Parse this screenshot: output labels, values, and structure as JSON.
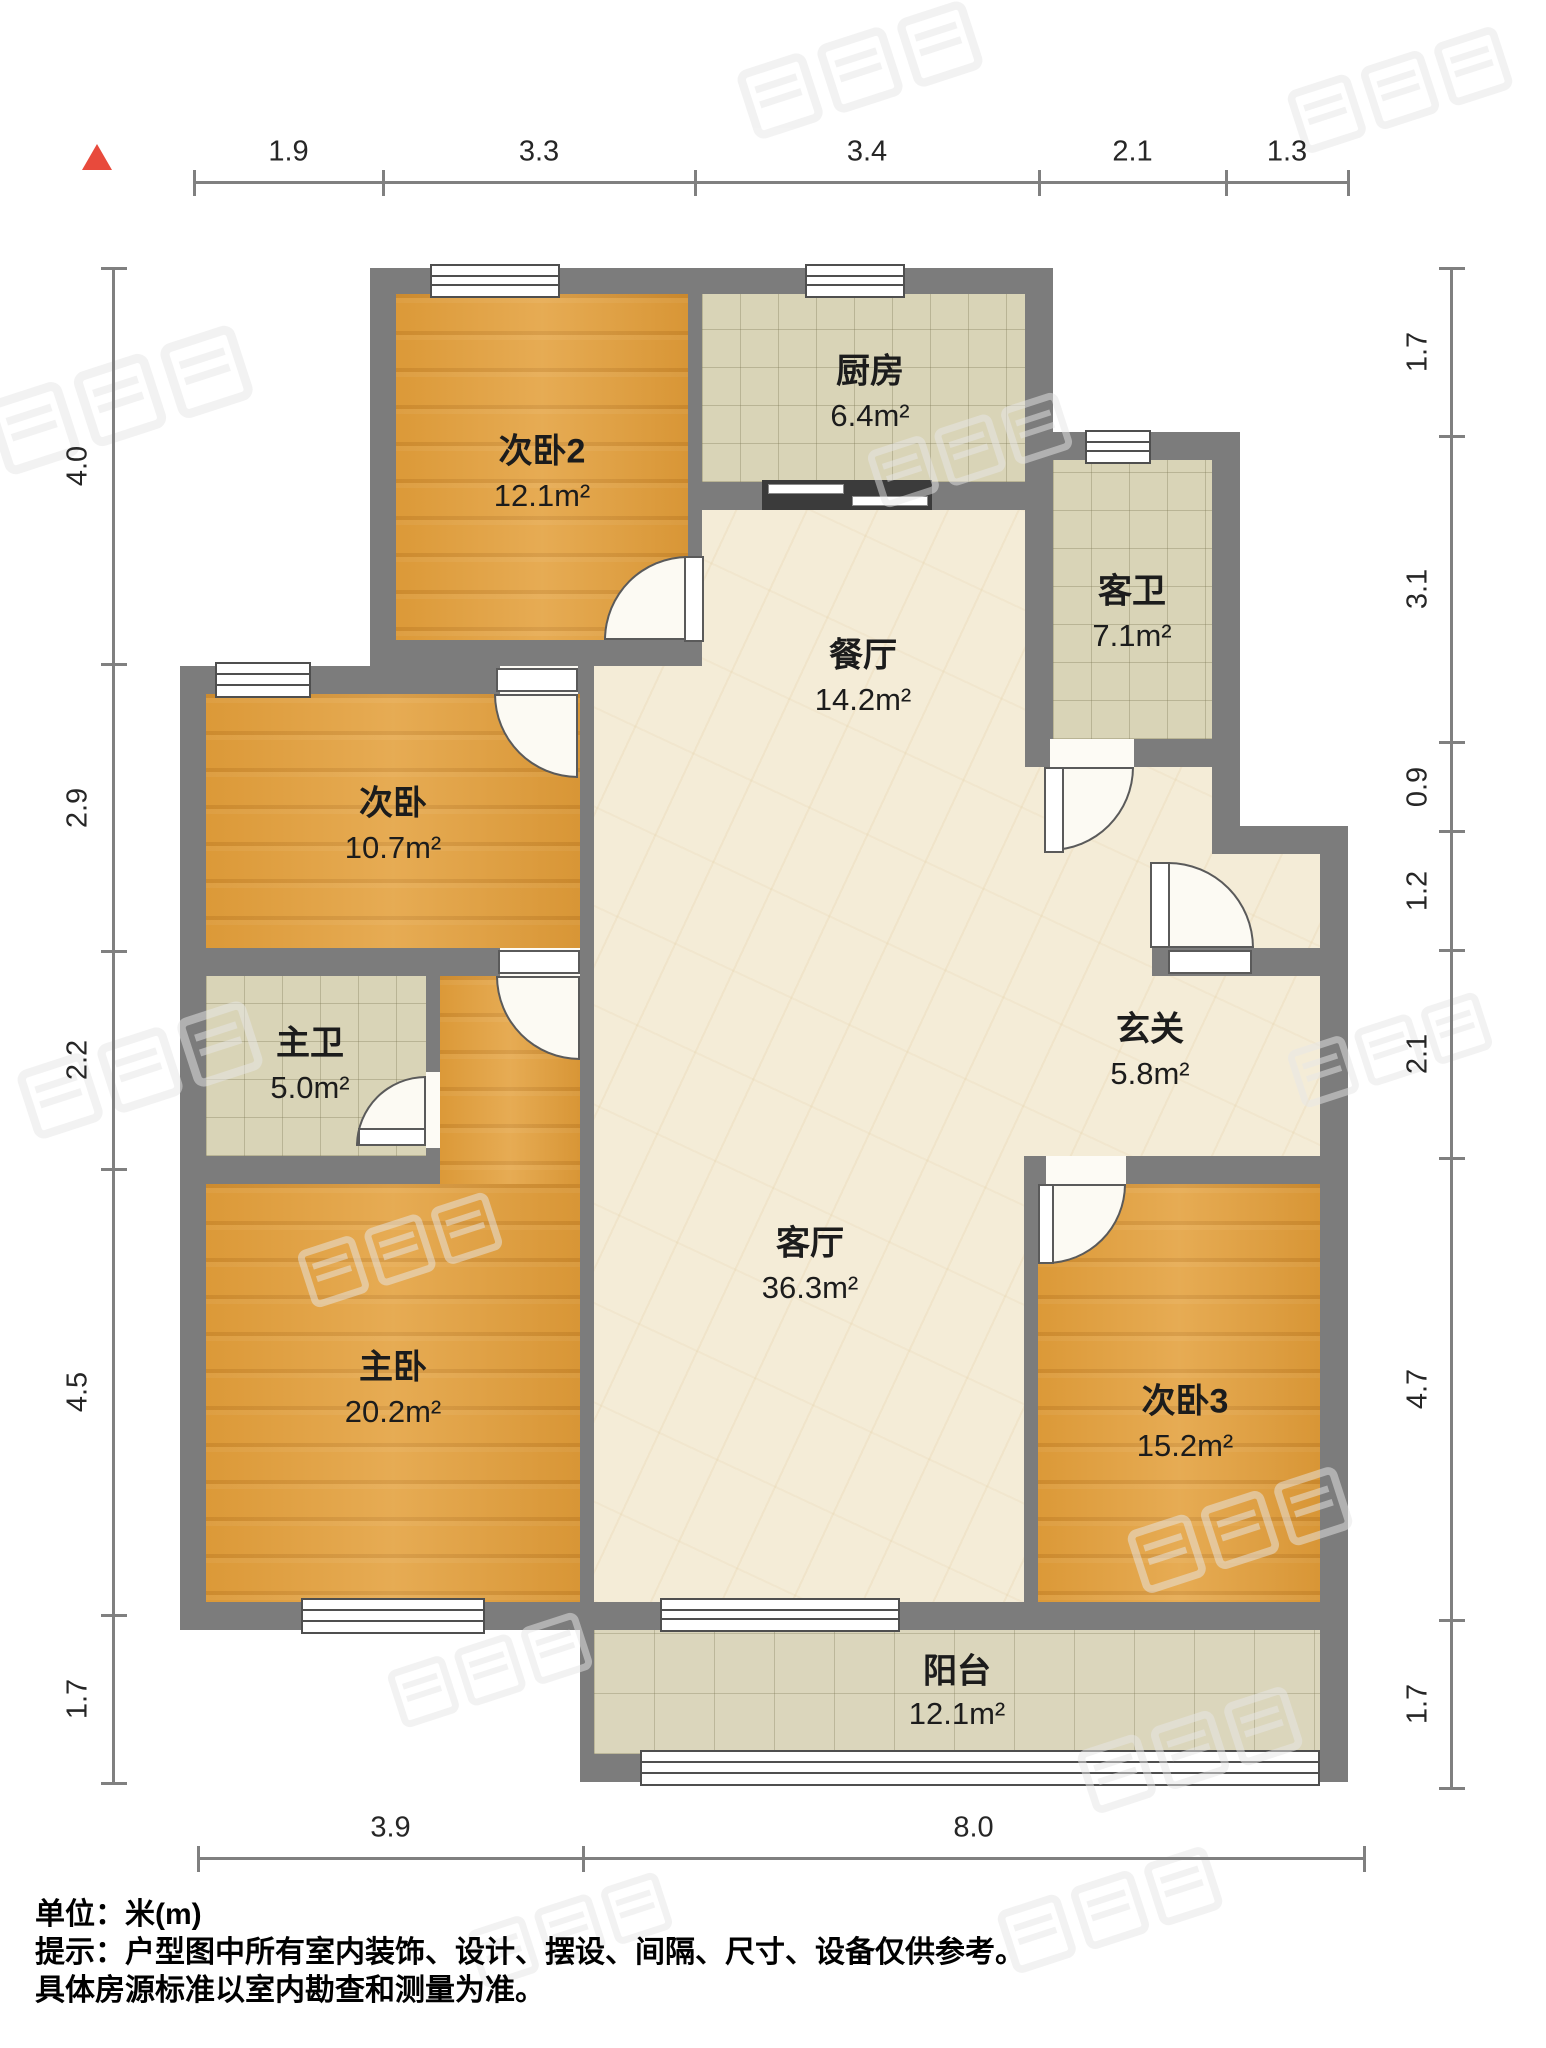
{
  "title": "户型图",
  "unit_label": "单位：米(m)",
  "notes": {
    "line1": "单位：米(m)",
    "line2": "提示：户型图中所有室内装饰、设计、摆设、间隔、尺寸、设备仅供参考。",
    "line3": "具体房源标准以室内勘查和测量为准。"
  },
  "colors": {
    "wall": "#7c7c7c",
    "wood_floor": "#e3a03c",
    "tile_floor": "#d9d4b7",
    "marble_floor": "#f4ecd7",
    "north_arrow": "#e84a3c",
    "dim_text": "#262626"
  },
  "north_icon": "north-triangle-icon",
  "rooms": [
    {
      "id": "living",
      "name": "客厅",
      "area": "36.3m²",
      "floor": "marble",
      "rects": [
        [
          594,
          510,
          726,
          1092
        ]
      ],
      "label": [
        810,
        1240
      ],
      "area_pos": [
        810,
        1288
      ]
    },
    {
      "id": "bedroom2",
      "name": "次卧2",
      "area": "12.1m²",
      "floor": "wood",
      "rects": [
        [
          396,
          294,
          292,
          346
        ]
      ],
      "label": [
        542,
        448
      ],
      "area_pos": [
        542,
        496
      ]
    },
    {
      "id": "kitchen",
      "name": "厨房",
      "area": "6.4m²",
      "floor": "tile",
      "rects": [
        [
          702,
          294,
          323,
          188
        ]
      ],
      "label": [
        870,
        368
      ],
      "area_pos": [
        870,
        416
      ]
    },
    {
      "id": "guestbath",
      "name": "客卫",
      "area": "7.1m²",
      "floor": "tile",
      "rects": [
        [
          1053,
          460,
          159,
          279
        ]
      ],
      "label": [
        1132,
        588
      ],
      "area_pos": [
        1132,
        636
      ]
    },
    {
      "id": "dining",
      "name": "餐厅",
      "area": "14.2m²",
      "floor": "none",
      "rects": [],
      "label": [
        863,
        652
      ],
      "area_pos": [
        863,
        700
      ]
    },
    {
      "id": "bedroom",
      "name": "次卧",
      "area": "10.7m²",
      "floor": "wood",
      "rects": [
        [
          206,
          694,
          374,
          254
        ]
      ],
      "label": [
        393,
        800
      ],
      "area_pos": [
        393,
        848
      ]
    },
    {
      "id": "masterbath",
      "name": "主卫",
      "area": "5.0m²",
      "floor": "tile",
      "rects": [
        [
          206,
          976,
          220,
          180
        ]
      ],
      "label": [
        310,
        1040
      ],
      "area_pos": [
        310,
        1088
      ]
    },
    {
      "id": "entry",
      "name": "玄关",
      "area": "5.8m²",
      "floor": "none",
      "rects": [],
      "label": [
        1150,
        1026
      ],
      "area_pos": [
        1150,
        1074
      ]
    },
    {
      "id": "master",
      "name": "主卧",
      "area": "20.2m²",
      "floor": "wood",
      "rects": [
        [
          440,
          976,
          140,
          626
        ],
        [
          206,
          1184,
          374,
          418
        ]
      ],
      "label": [
        393,
        1364
      ],
      "area_pos": [
        393,
        1412
      ]
    },
    {
      "id": "bedroom3",
      "name": "次卧3",
      "area": "15.2m²",
      "floor": "wood",
      "rects": [
        [
          1038,
          1184,
          282,
          418
        ]
      ],
      "label": [
        1185,
        1398
      ],
      "area_pos": [
        1185,
        1446
      ]
    },
    {
      "id": "balcony",
      "name": "阳台",
      "area": "12.1m²",
      "floor": "tile-lg",
      "rects": [
        [
          594,
          1630,
          726,
          124
        ]
      ],
      "label": [
        957,
        1668
      ],
      "area_pos": [
        957,
        1714
      ]
    }
  ],
  "dimensions": {
    "top": {
      "labels": [
        "1.9",
        "3.3",
        "3.4",
        "2.1",
        "1.3"
      ],
      "ticks": [
        194,
        383,
        695,
        1039,
        1226,
        1348
      ],
      "line_y": 181
    },
    "left": {
      "labels": [
        "4.0",
        "2.9",
        "2.2",
        "4.5",
        "1.7"
      ],
      "ticks": [
        268,
        664,
        951,
        1169,
        1615,
        1783
      ],
      "line_x": 112
    },
    "right": {
      "labels": [
        "1.7",
        "3.1",
        "0.9",
        "1.2",
        "2.1",
        "4.7",
        "1.7"
      ],
      "ticks": [
        268,
        436,
        742,
        831,
        950,
        1158,
        1620,
        1788
      ],
      "line_x": 1450
    },
    "bottom": {
      "labels": [
        "3.9",
        "8.0"
      ],
      "ticks": [
        198,
        583,
        1364
      ],
      "line_y": 1857
    }
  }
}
